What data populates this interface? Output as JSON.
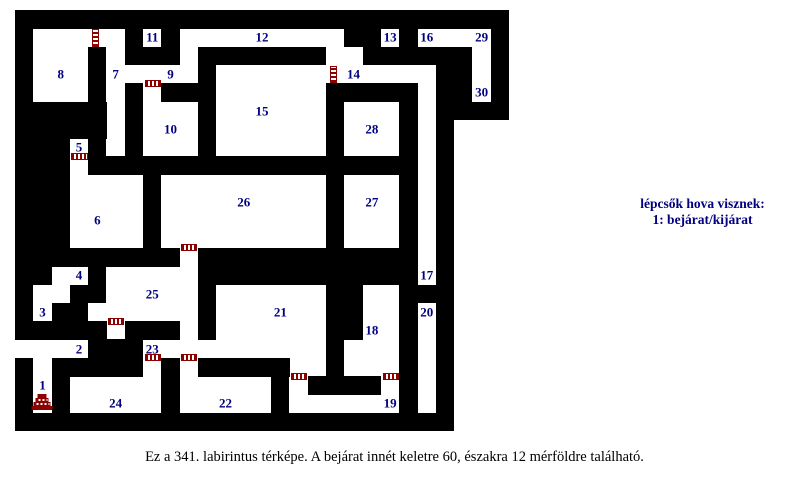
{
  "page": {
    "background": "#ffffff",
    "width": 789,
    "height": 493
  },
  "legend": {
    "title": "lépcsők hova visznek:",
    "entry": "1: bejárat/kijárat",
    "color": "#000080"
  },
  "caption": {
    "text": "Ez a 341. labirintus térképe. A bejárat innét keletre 60, északra 12 mérföldre található."
  },
  "maze": {
    "origin_x": 15,
    "origin_y": 10,
    "cell": 18.3,
    "cols": 27,
    "rows": 23,
    "wall_color": "#000000",
    "floor_color": "#ffffff",
    "label_color": "#000080",
    "ladder_color": "#8b0000",
    "grid": [
      "###########################",
      "#.....#.#.........##.#....#",
      "#...#.###.#######..######.#",
      "#...#.....#............##.#",
      "#...#.#.###......#####.##.#",
      "#####.#...#......#...#.####",
      "#####.#...#......#...#.#   ",
      "###.#.#...#......#...#.#   ",
      "###.##################.#   ",
      "###....#.........#...#.#   ",
      "###....#.........#...#.#   ",
      "###....#.........#...#.#   ",
      "###....#.........#...#.#   ",
      "#########.############.#   ",
      "##..#.....############.#   ",
      "#..##.....#......##..###   ",
      "#.##......#......##..#.#   ",
      "#####.###.#......##..#.#   ",
      "....###..........#...#.#   ",
      "#.#####.#.#####..#...#.#   ",
      "#.#.....#.....#.####.#.#   ",
      "#.#.....#.....#......#.#   ",
      "########################   "
    ],
    "room_labels": [
      {
        "n": "1",
        "col": 1,
        "row": 20
      },
      {
        "n": "2",
        "col": 3,
        "row": 18
      },
      {
        "n": "3",
        "col": 1,
        "row": 16
      },
      {
        "n": "4",
        "col": 3,
        "row": 14
      },
      {
        "n": "5",
        "col": 3,
        "row": 7
      },
      {
        "n": "6",
        "col": 4,
        "row": 11
      },
      {
        "n": "7",
        "col": 5,
        "row": 3
      },
      {
        "n": "8",
        "col": 2,
        "row": 3
      },
      {
        "n": "9",
        "col": 8,
        "row": 3
      },
      {
        "n": "10",
        "col": 8,
        "row": 6
      },
      {
        "n": "11",
        "col": 7,
        "row": 1
      },
      {
        "n": "12",
        "col": 13,
        "row": 1
      },
      {
        "n": "13",
        "col": 20,
        "row": 1
      },
      {
        "n": "14",
        "col": 18,
        "row": 3
      },
      {
        "n": "15",
        "col": 13,
        "row": 5
      },
      {
        "n": "16",
        "col": 22,
        "row": 1
      },
      {
        "n": "17",
        "col": 22,
        "row": 14
      },
      {
        "n": "18",
        "col": 19,
        "row": 17
      },
      {
        "n": "19",
        "col": 20,
        "row": 21
      },
      {
        "n": "20",
        "col": 22,
        "row": 16
      },
      {
        "n": "21",
        "col": 14,
        "row": 16
      },
      {
        "n": "22",
        "col": 11,
        "row": 21
      },
      {
        "n": "23",
        "col": 7,
        "row": 18
      },
      {
        "n": "24",
        "col": 5,
        "row": 21
      },
      {
        "n": "25",
        "col": 7,
        "row": 15
      },
      {
        "n": "26",
        "col": 12,
        "row": 10
      },
      {
        "n": "27",
        "col": 19,
        "row": 10
      },
      {
        "n": "28",
        "col": 19,
        "row": 6
      },
      {
        "n": "29",
        "col": 25,
        "row": 1
      },
      {
        "n": "30",
        "col": 25,
        "row": 4
      }
    ],
    "ladders": [
      {
        "col": 4,
        "row": 1,
        "orient": "v"
      },
      {
        "col": 17,
        "row": 3,
        "orient": "v"
      },
      {
        "col": 7,
        "row": 4,
        "orient": "h"
      },
      {
        "col": 3,
        "row": 8,
        "orient": "h"
      },
      {
        "col": 9,
        "row": 13,
        "orient": "h"
      },
      {
        "col": 5,
        "row": 17,
        "orient": "h"
      },
      {
        "col": 7,
        "row": 19,
        "orient": "h"
      },
      {
        "col": 9,
        "row": 19,
        "orient": "h"
      },
      {
        "col": 15,
        "row": 20,
        "orient": "h"
      },
      {
        "col": 20,
        "row": 20,
        "orient": "h"
      }
    ],
    "entrance": {
      "col": 1,
      "row": 21
    }
  }
}
